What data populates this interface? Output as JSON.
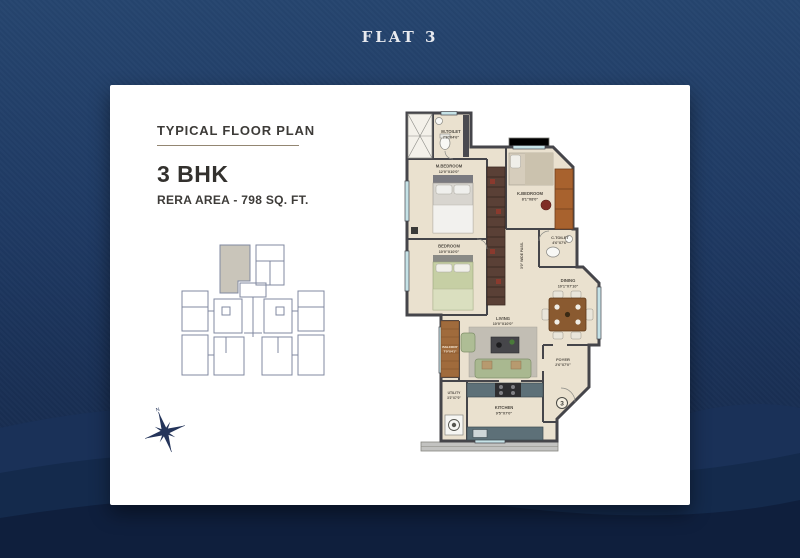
{
  "page": {
    "title": "FLAT 3"
  },
  "card": {
    "plan_type_label": "TYPICAL FLOOR PLAN",
    "config": "3 BHK",
    "rera_area": "RERA AREA - 798 SQ. FT.",
    "unit_number": "3"
  },
  "floor_plan": {
    "passage_label": "3'0\" WIDE PASS.",
    "compass_label": "N",
    "rooms": {
      "m_toilet": {
        "name": "M.TOILET",
        "dim": "7'6\"X4'6\""
      },
      "m_bedroom": {
        "name": "M.BEDROOM",
        "dim": "12'0\"X10'0\""
      },
      "k_bedroom": {
        "name": "K.BEDROOM",
        "dim": "8'1\"X8'0\""
      },
      "c_toilet": {
        "name": "C.TOILET",
        "dim": "4'6\"X7'6\""
      },
      "bedroom": {
        "name": "BEDROOM",
        "dim": "10'0\"X10'0\""
      },
      "dining": {
        "name": "DINING",
        "dim": "10'1\"X7'10\""
      },
      "living": {
        "name": "LIVING",
        "dim": "10'0\"X10'0\""
      },
      "balcony": {
        "name": "BALCONY",
        "dim": "7'0\"X4'1\""
      },
      "utility": {
        "name": "UTILITY",
        "dim": "3'2\"X7'0\""
      },
      "kitchen": {
        "name": "KITCHEN",
        "dim": "9'5\"X7'0\""
      },
      "foyer": {
        "name": "FOYER",
        "dim": "2'6\"X7'0\""
      }
    }
  },
  "colors": {
    "background_navy": "#1f3a64",
    "wave_dark": "#0f1f3d",
    "card_white": "#ffffff",
    "wall": "#45454a",
    "floor_beige": "#eae1cf",
    "window_blue": "#c5e2e6",
    "wood": "#a06b3c",
    "title_text": "#e8eaef"
  }
}
